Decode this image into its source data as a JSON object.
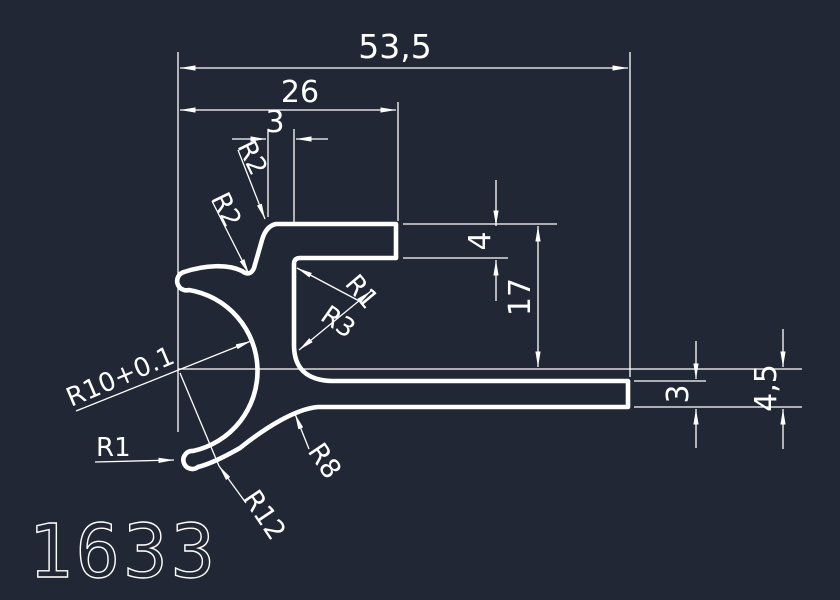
{
  "drawing": {
    "part_number": "1633",
    "background_color": "#212734",
    "line_color": "#ffffff",
    "dimensions": {
      "overall_width": "53,5",
      "flange_width": "26",
      "top_wall_thickness": "3",
      "flange_thickness": "4",
      "flange_to_axis_height": "17",
      "leg_thickness": "3",
      "axis_to_bottom_height": "4,5"
    },
    "radii": {
      "flange_corner": "R2",
      "finger_crease": "R2",
      "inner_corner": "R1",
      "web_fillet": "R3",
      "curl_inner": "R10+0.1",
      "finger_tip": "R1",
      "curl_outer": "R12",
      "leg_root_fillet": "R8"
    }
  }
}
